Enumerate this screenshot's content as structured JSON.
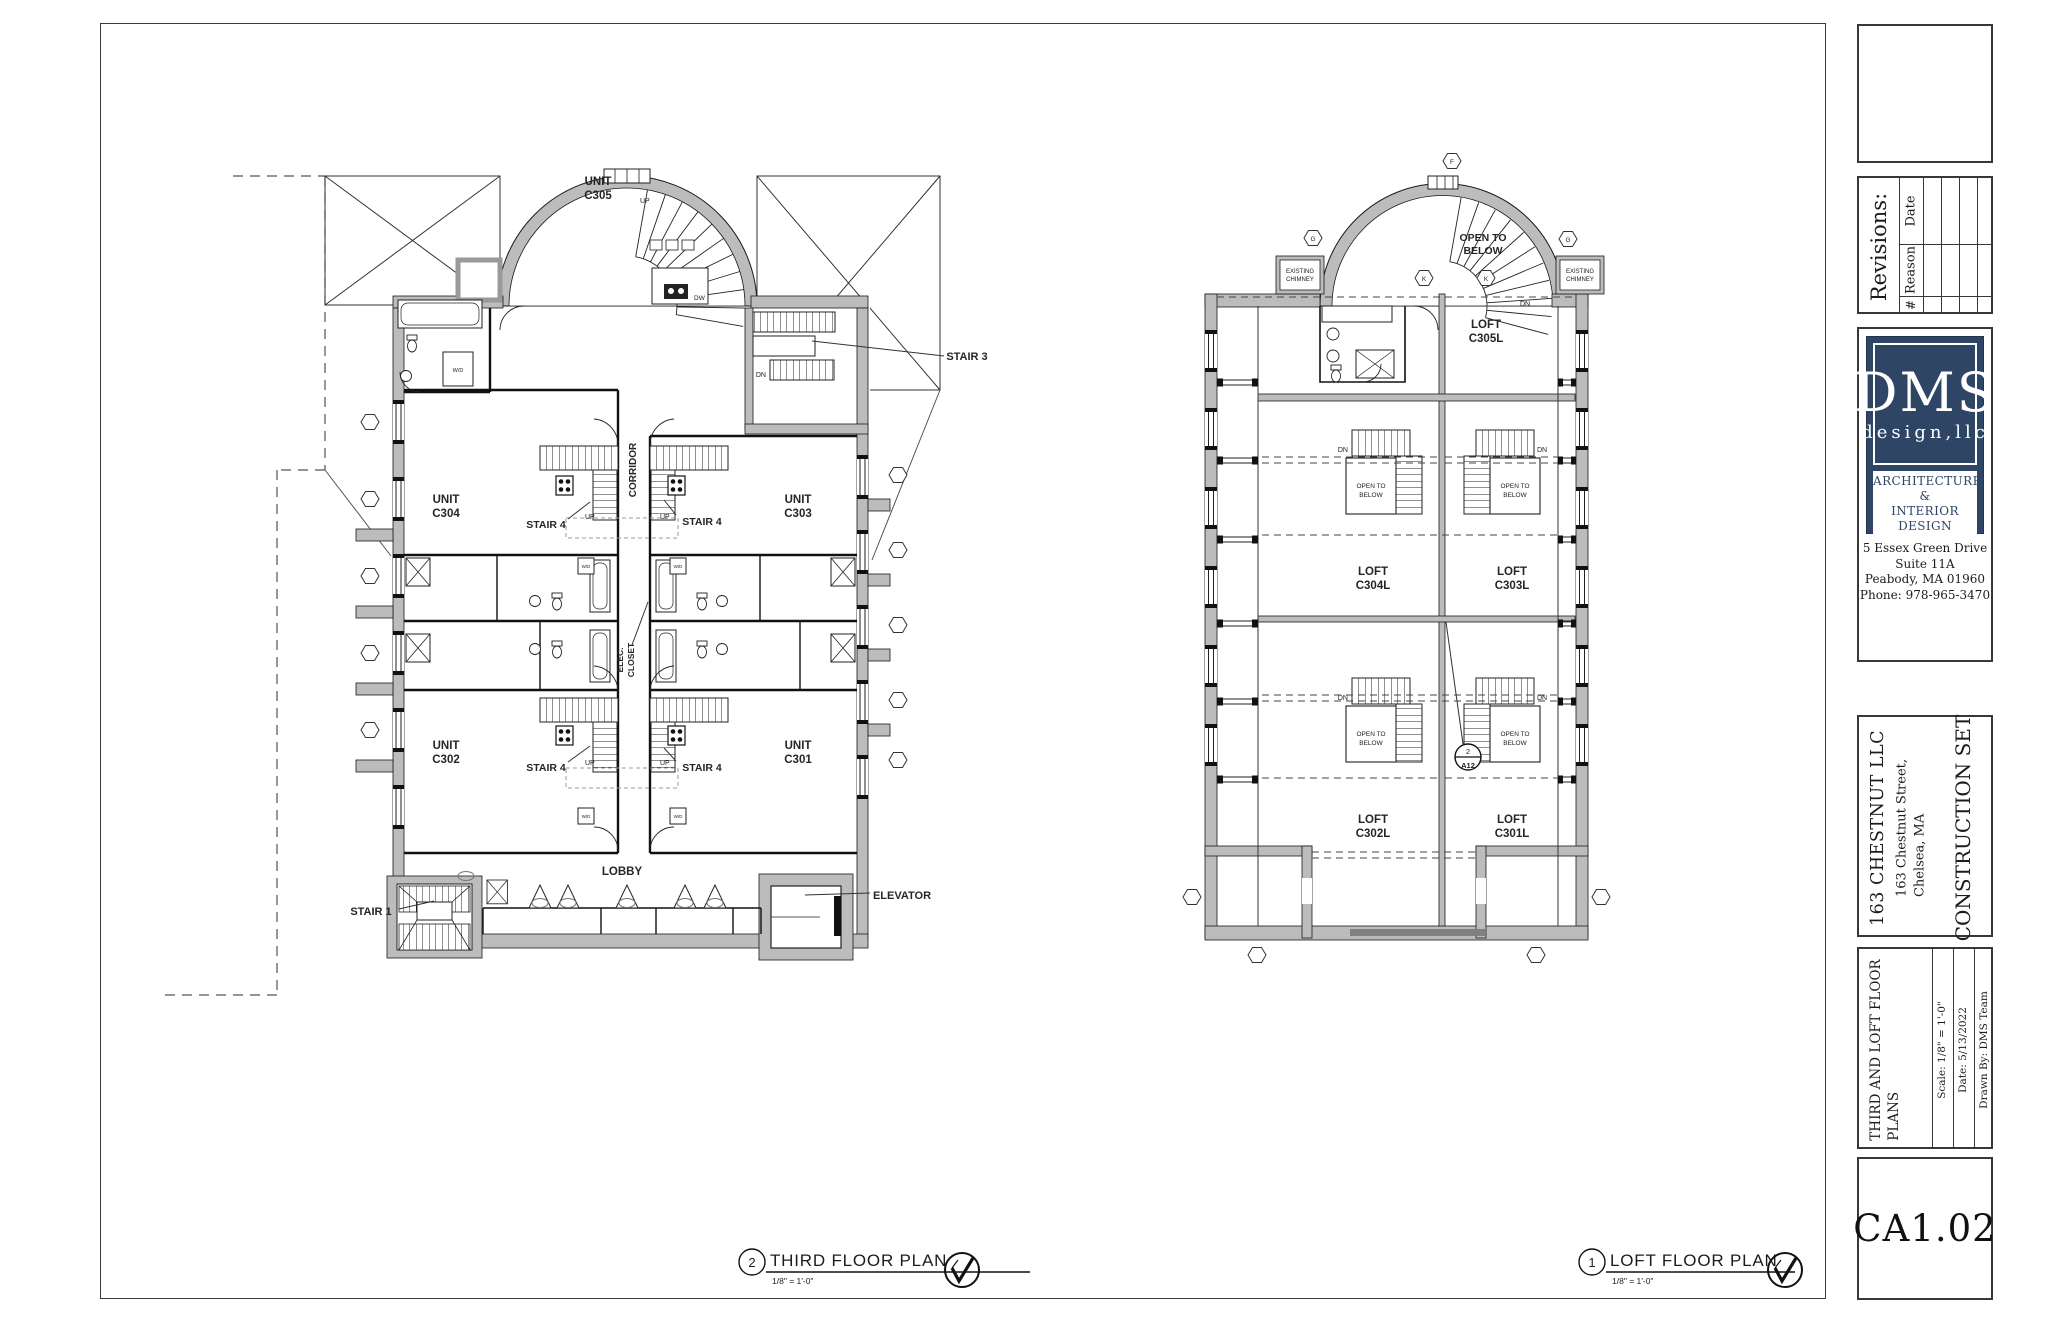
{
  "titleblock": {
    "revisions": {
      "title": "Revisions:",
      "date": "Date",
      "reason": "Reason",
      "num": "#"
    },
    "firm": {
      "name": "DMS",
      "sub": "design,llc",
      "tag1": "ARCHITECTURE &",
      "tag2": "INTERIOR DESIGN",
      "addr1": "5 Essex Green Drive",
      "addr2": "Suite 11A",
      "addr3": "Peabody, MA 01960",
      "addr4": "Phone: 978-965-3470"
    },
    "project": {
      "client": "163 CHESTNUT LLC",
      "addr1": "163 Chestnut Street,",
      "addr2": "Chelsea, MA",
      "set": "CONSTRUCTION SET"
    },
    "sheet": {
      "title1": "THIRD AND LOFT FLOOR",
      "title2": "PLANS",
      "scale": "Scale:  1/8\" = 1'-0\"",
      "date": "Date:  5/13/2022",
      "drawn": "Drawn By:   DMS Team",
      "number": "CA1.02"
    }
  },
  "plan_titles": {
    "third": {
      "num": "2",
      "title": "THIRD FLOOR PLAN",
      "scale": "1/8\" = 1'-0\""
    },
    "loft": {
      "num": "1",
      "title": "LOFT FLOOR PLAN",
      "scale": "1/8\" = 1'-0\""
    }
  },
  "third_plan": {
    "units": {
      "c305": [
        "UNIT",
        "C305"
      ],
      "c304": [
        "UNIT",
        "C304"
      ],
      "c303": [
        "UNIT",
        "C303"
      ],
      "c302": [
        "UNIT",
        "C302"
      ],
      "c301": [
        "UNIT",
        "C301"
      ]
    },
    "stairs": {
      "s1": "STAIR 1",
      "s3": "STAIR 3",
      "s4": "STAIR 4"
    },
    "rooms": {
      "corridor": "CORRIDOR",
      "lobby": "LOBBY",
      "elevator": "ELEVATOR",
      "elec1": "ELEC.",
      "elec2": "CLOSET"
    },
    "marks": {
      "up": "UP",
      "dn": "DN",
      "dw": "DW",
      "wd": "W/D"
    }
  },
  "loft_plan": {
    "units": {
      "c305l": [
        "LOFT",
        "C305L"
      ],
      "c304l": [
        "LOFT",
        "C304L"
      ],
      "c303l": [
        "LOFT",
        "C303L"
      ],
      "c302l": [
        "LOFT",
        "C302L"
      ],
      "c301l": [
        "LOFT",
        "C301L"
      ]
    },
    "open_below": [
      "OPEN TO",
      "BELOW"
    ],
    "chimney": [
      "EXISTING",
      "CHIMNEY"
    ],
    "marks": {
      "dn": "DN"
    },
    "detail": {
      "num": "2",
      "sheet": "A12"
    },
    "grid": {
      "f": "F",
      "g": "G",
      "k": "K"
    }
  },
  "colors": {
    "wall": "#bcbcbc",
    "line": "#1c1c1c",
    "logo_navy": "#2f4566"
  }
}
